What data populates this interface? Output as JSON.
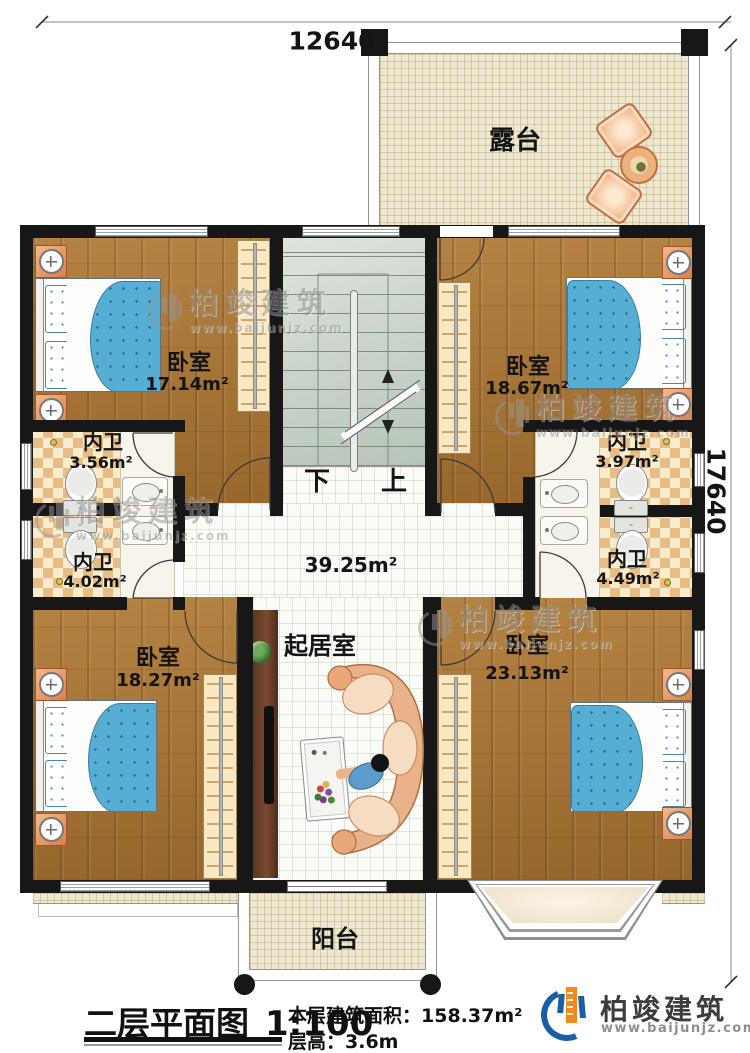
{
  "dimensions": {
    "top": "12640",
    "right": "17640"
  },
  "rooms": {
    "terrace": {
      "name": "露台"
    },
    "bedroom_nw": {
      "name": "卧室",
      "area": "17.14m²"
    },
    "bedroom_ne": {
      "name": "卧室",
      "area": "18.67m²"
    },
    "bath_nw": {
      "name": "内卫",
      "area": "3.56m²"
    },
    "bath_ne": {
      "name": "内卫",
      "area": "3.97m²"
    },
    "bath_w": {
      "name": "内卫",
      "area": "4.02m²"
    },
    "bath_e": {
      "name": "内卫",
      "area": "4.49m²"
    },
    "hall": {
      "area": "39.25m²"
    },
    "living": {
      "name": "起居室"
    },
    "bedroom_sw": {
      "name": "卧室",
      "area": "18.27m²"
    },
    "bedroom_se": {
      "name": "卧室",
      "area": "23.13m²"
    },
    "balcony": {
      "name": "阳台"
    }
  },
  "stairs": {
    "down": "下",
    "up": "上"
  },
  "watermark": {
    "brand": "柏竣建筑",
    "url": "www.baijunjz.com"
  },
  "footer": {
    "title": "二层平面图",
    "scale": "1:100",
    "area_label": "本层建筑面积：",
    "area_value": "158.37m²",
    "floor_height_label": "层高：",
    "floor_height_value": "3.6m"
  },
  "logo": {
    "brand": "柏竣建筑",
    "url": "www.baijunjz.com"
  },
  "colors": {
    "wall": "#171717",
    "bed_blue": "#57aed4",
    "brand_blue": "#1b5ea6",
    "brand_orange": "#f08a1e"
  }
}
